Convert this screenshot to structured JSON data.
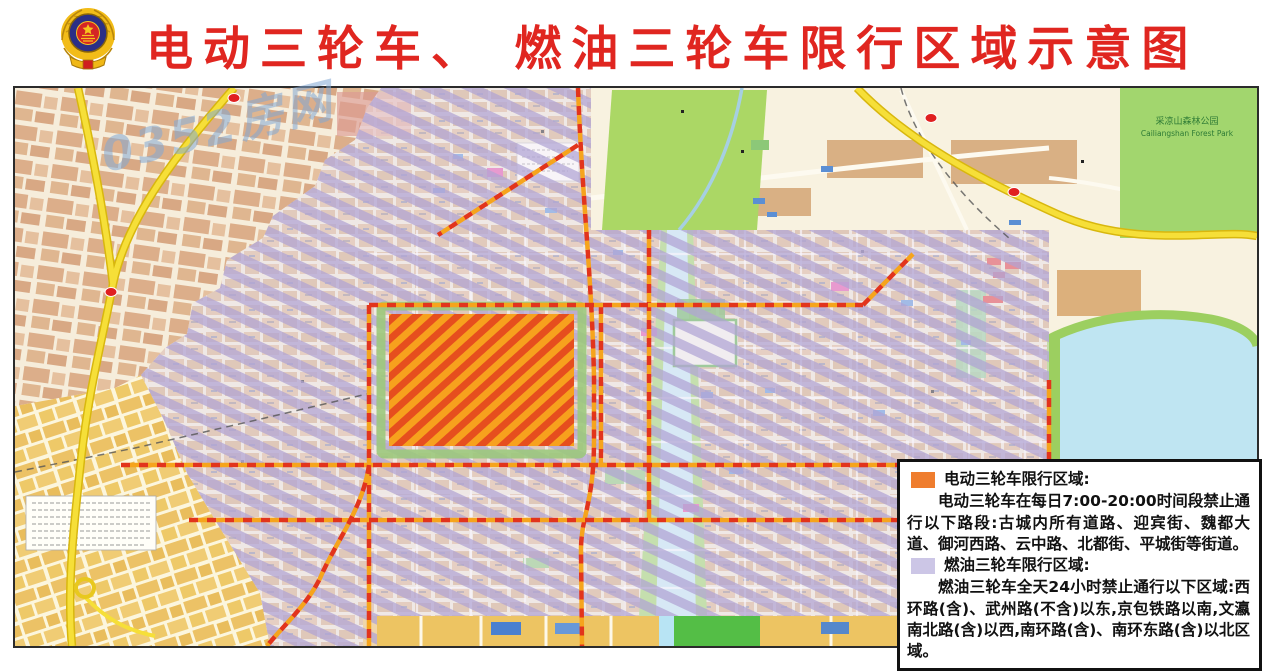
{
  "header": {
    "title": "电动三轮车、 燃油三轮车限行区域示意图",
    "title_color": "#e02620",
    "emblem": "china-police-badge"
  },
  "watermark": {
    "text": "0352房网",
    "color": "#82a8d4"
  },
  "map": {
    "labels": {
      "forest_park_cn": "采凉山森林公园",
      "forest_park_en": "Cailiangshan Forest Park"
    },
    "colors": {
      "electric_zone_hatch": "#f7a11d",
      "electric_zone_hatch2": "#e64e1e",
      "fuel_zone_hatch": "#b0a4d4",
      "restricted_road_red": "#e2341c",
      "restricted_road_orange": "#f6a41c",
      "highway_yellow": "#f6df38",
      "park_green": "#abd765",
      "water_blue": "#bfe5f2",
      "city_block_tan": "#d8b28c"
    }
  },
  "legend": {
    "electric": {
      "swatch_color": "#ef7d2e",
      "heading": "电动三轮车限行区域:",
      "body": "电动三轮车在每日7:00-20:00时间段禁止通行以下路段:古城内所有道路、迎宾街、魏都大道、御河西路、云中路、北都街、平城街等街道。"
    },
    "fuel": {
      "swatch_color": "#ccc6e6",
      "heading": "燃油三轮车限行区域:",
      "body": "燃油三轮车全天24小时禁止通行以下区域:西环路(含)、武州路(不含)以东,京包铁路以南,文瀛南北路(含)以西,南环路(含)、南环东路(含)以北区域。"
    }
  }
}
